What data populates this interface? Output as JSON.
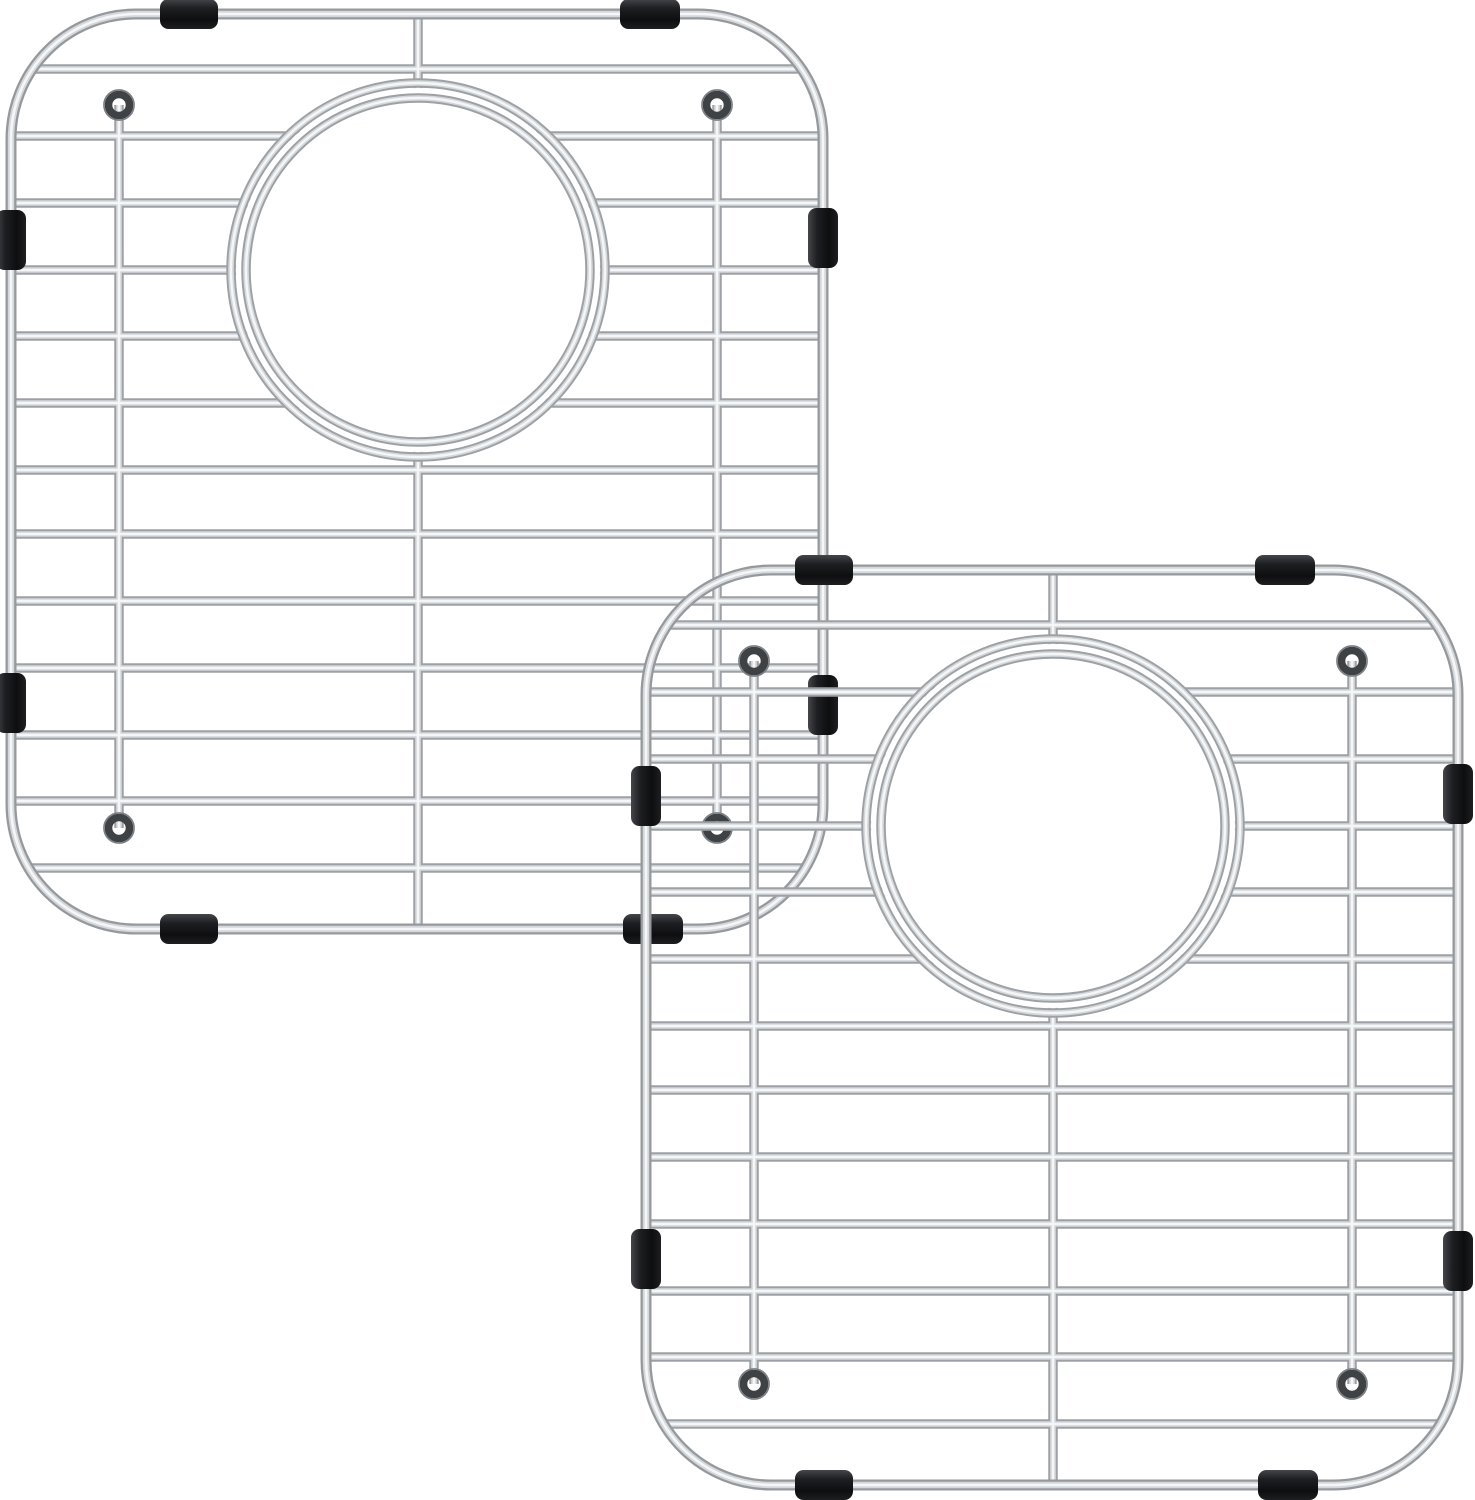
{
  "page": {
    "background": "#ffffff",
    "description": "Two overlapping stainless steel kitchen sink bottom grids (sink protectors) with round rear drain openings, wire loop feet and black rubber bumpers, on a plain white background"
  },
  "canvas": {
    "width": 1475,
    "height": 1500
  },
  "colors": {
    "background": "#ffffff",
    "wire_base": "#9da1a5",
    "wire_mid": "#d5d8da",
    "wire_highlight": "#f5f6f7",
    "frame_base": "#95999d",
    "hook_ring": "#3f4245",
    "hook_rim": "#7b7f83",
    "bumper_dark": "#0e0e10",
    "bumper_mid": "#1e1f22",
    "bumper_light": "#45464a"
  },
  "grids": [
    {
      "name": "sink-grid-back",
      "x": 6,
      "y": 9
    },
    {
      "name": "sink-grid-front",
      "x": 641,
      "y": 565
    }
  ],
  "grid_template": {
    "frame": {
      "x": 5,
      "y": 5,
      "width": 812,
      "height": 915,
      "corner_radius": 125
    },
    "clip": {
      "x": 9,
      "y": 9,
      "width": 804,
      "height": 907,
      "corner_radius": 119
    },
    "wire_span": {
      "x1": 5,
      "x2": 817
    },
    "horizontal_wire_ys": [
      60,
      127,
      194,
      261,
      327,
      394,
      461,
      525,
      592,
      659,
      726,
      792,
      859
    ],
    "vertical_wires": [
      {
        "name": "center-divider-wire",
        "x": 412,
        "y1": 5,
        "y2": 920
      },
      {
        "name": "left-foot-wire",
        "x": 113,
        "y1": 96,
        "y2": 819
      },
      {
        "name": "right-foot-wire",
        "x": 711,
        "y1": 96,
        "y2": 819
      }
    ],
    "drain_opening": {
      "cx": 412,
      "cy": 261,
      "outer_radius": 187,
      "inner_radius": 172,
      "fill_radius": 182
    },
    "feet_loops": [
      {
        "cx": 113,
        "cy": 96
      },
      {
        "cx": 711,
        "cy": 96
      },
      {
        "cx": 113,
        "cy": 819
      },
      {
        "cx": 711,
        "cy": 819
      }
    ],
    "loop_radius": 10.5,
    "bumpers": [
      {
        "x": 154,
        "y": -10,
        "w": 58,
        "h": 30,
        "side": "top"
      },
      {
        "x": 614,
        "y": -10,
        "w": 60,
        "h": 30,
        "side": "top"
      },
      {
        "x": 154,
        "y": 905,
        "w": 58,
        "h": 30,
        "side": "bottom"
      },
      {
        "x": 617,
        "y": 905,
        "w": 60,
        "h": 30,
        "side": "bottom"
      },
      {
        "x": -10,
        "y": 201,
        "w": 30,
        "h": 60,
        "side": "left"
      },
      {
        "x": -10,
        "y": 664,
        "w": 30,
        "h": 60,
        "side": "left"
      },
      {
        "x": 802,
        "y": 199,
        "w": 30,
        "h": 60,
        "side": "right"
      },
      {
        "x": 802,
        "y": 666,
        "w": 30,
        "h": 60,
        "side": "right"
      }
    ]
  }
}
